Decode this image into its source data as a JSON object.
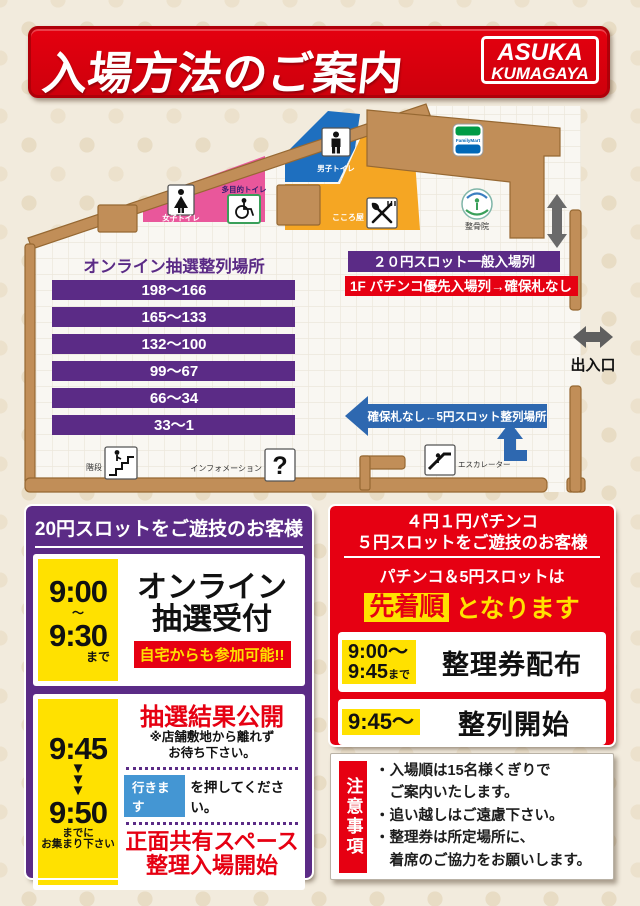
{
  "colors": {
    "red": "#E60012",
    "purple": "#5B2B86",
    "yellow": "#FFE100",
    "button_blue": "#4496D3",
    "arrow_blue": "#2E68B0",
    "wall_tan": "#C18E58",
    "zone_pink": "#E9579B",
    "zone_blue": "#1E6FBF",
    "zone_orange": "#F5A623"
  },
  "header": {
    "title": "入場方法のご案内",
    "brand_line1": "ASUKA",
    "brand_line2": "KUMAGAYA"
  },
  "map": {
    "lottery_area_title": "オンライン抽選整列場所",
    "lottery_bars": [
      "198〜166",
      "165〜133",
      "132〜100",
      "99〜67",
      "66〜34",
      "33〜1"
    ],
    "banner_slot_general": "２０円スロット一般入場列",
    "banner_pachinko_priority": "1F パチンコ優先入場列→確保札なし",
    "banner_5yen_queue": "確保札なし←5円スロット整列場所",
    "exit_label": "出入口",
    "facilities": {
      "womens_toilet": "女子トイレ",
      "multipurpose_toilet": "多目的トイレ",
      "mens_toilet": "男子トイレ",
      "kokoroya": "こころ屋",
      "familymart": "FamilyMart",
      "seikotsuin": "整骨院",
      "stairs": "階段",
      "information": "インフォメーション",
      "escalator": "エスカレーター"
    }
  },
  "left_panel": {
    "header": "20円スロットをご遊技のお客様",
    "step1": {
      "time_start": "9:00",
      "tilde": "〜",
      "time_end": "9:30",
      "time_suffix": "まで",
      "title_line1": "オンライン",
      "title_line2": "抽選受付",
      "note": "自宅からも参加可能!!"
    },
    "step2": {
      "time_start": "9:45",
      "arrow": "▼",
      "time_end": "9:50",
      "deadline_line1": "までに",
      "deadline_line2": "お集まり下さい",
      "result_title": "抽選結果公開",
      "result_note_line1": "※店舗敷地から離れず",
      "result_note_line2": "お待ち下さい。",
      "button_label": "行きます",
      "button_suffix": "を押してください。",
      "final_line1": "正面共有スペース",
      "final_line2": "整理入場開始"
    }
  },
  "right_panel": {
    "header_line1": "４円１円パチンコ",
    "header_line2": "５円スロットをご遊技のお客様",
    "subtitle": "パチンコ＆5円スロットは",
    "highlight": "先着順",
    "highlight_suffix": "となります",
    "row1": {
      "time_line1": "9:00〜",
      "time_line2": "9:45",
      "time_suffix": "まで",
      "label": "整理券配布"
    },
    "row2": {
      "time": "9:45〜",
      "label": "整列開始"
    }
  },
  "notes": {
    "tab": "注意事項",
    "lines": [
      "・入場順は15名様くぎりで",
      "　ご案内いたします。",
      "・追い越しはご遠慮下さい。",
      "・整理券は所定場所に、",
      "　着席のご協力をお願いします。"
    ]
  }
}
